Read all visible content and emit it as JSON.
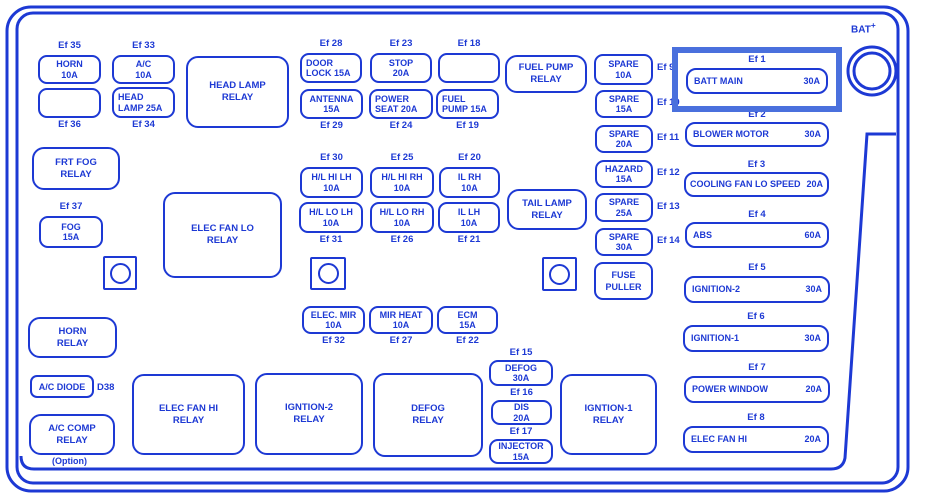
{
  "colors": {
    "line": "#1d39d4",
    "highlight": "#4a70dd",
    "background": "#ffffff"
  },
  "battery": {
    "label": "BAT",
    "sup": "+"
  },
  "misc": {
    "diode_code": "D38",
    "option_note": "(Option)"
  },
  "fuses": [
    {
      "ef": "Ef 35",
      "line1": "HORN",
      "line2": "10A"
    },
    {
      "ef": "Ef 33",
      "line1": "A/C",
      "line2": "10A"
    },
    {
      "ef": "Ef 36",
      "line1": "",
      "line2": ""
    },
    {
      "ef": "Ef 34",
      "line1": "HEAD",
      "line2": "LAMP 25A"
    },
    {
      "ef": "Ef 37",
      "line1": "FOG",
      "line2": "15A"
    },
    {
      "ef": "Ef 28",
      "line1": "DOOR",
      "line2": "LOCK 15A"
    },
    {
      "ef": "Ef 23",
      "line1": "STOP",
      "line2": "20A"
    },
    {
      "ef": "Ef 18",
      "line1": "",
      "line2": ""
    },
    {
      "ef": "Ef 29",
      "line1": "ANTENNA",
      "line2": "15A"
    },
    {
      "ef": "Ef 24",
      "line1": "POWER",
      "line2": "SEAT 20A"
    },
    {
      "ef": "Ef 19",
      "line1": "FUEL",
      "line2": "PUMP 15A"
    },
    {
      "ef": "Ef 30",
      "line1": "H/L HI LH",
      "line2": "10A"
    },
    {
      "ef": "Ef 25",
      "line1": "H/L HI RH",
      "line2": "10A"
    },
    {
      "ef": "Ef 20",
      "line1": "IL RH",
      "line2": "10A"
    },
    {
      "ef": "Ef 31",
      "line1": "H/L LO LH",
      "line2": "10A"
    },
    {
      "ef": "Ef 26",
      "line1": "H/L LO RH",
      "line2": "10A"
    },
    {
      "ef": "Ef 21",
      "line1": "IL LH",
      "line2": "10A"
    },
    {
      "ef": "Ef 32",
      "line1": "ELEC. MIR",
      "line2": "10A"
    },
    {
      "ef": "Ef 27",
      "line1": "MIR HEAT",
      "line2": "10A"
    },
    {
      "ef": "Ef 22",
      "line1": "ECM",
      "line2": "15A"
    },
    {
      "ef": "Ef 9",
      "line1": "SPARE",
      "line2": "10A"
    },
    {
      "ef": "Ef 10",
      "line1": "SPARE",
      "line2": "15A"
    },
    {
      "ef": "Ef 11",
      "line1": "SPARE",
      "line2": "20A"
    },
    {
      "ef": "Ef 12",
      "line1": "HAZARD",
      "line2": "15A"
    },
    {
      "ef": "Ef 13",
      "line1": "SPARE",
      "line2": "25A"
    },
    {
      "ef": "Ef 14",
      "line1": "SPARE",
      "line2": "30A"
    },
    {
      "ef": "Ef 15",
      "line1": "DEFOG",
      "line2": "30A"
    },
    {
      "ef": "Ef 16",
      "line1": "DIS",
      "line2": "20A"
    },
    {
      "ef": "Ef 17",
      "line1": "INJECTOR",
      "line2": "15A"
    },
    {
      "ef": "Ef 1",
      "line1": "BATT MAIN",
      "line2": "30A"
    },
    {
      "ef": "Ef 2",
      "line1": "BLOWER MOTOR",
      "line2": "30A"
    },
    {
      "ef": "Ef 3",
      "line1": "COOLING FAN LO SPEED",
      "line2": "20A"
    },
    {
      "ef": "Ef 4",
      "line1": "ABS",
      "line2": "60A"
    },
    {
      "ef": "Ef 5",
      "line1": "IGNITION-2",
      "line2": "30A"
    },
    {
      "ef": "Ef 6",
      "line1": "IGNITION-1",
      "line2": "30A"
    },
    {
      "ef": "Ef 7",
      "line1": "POWER WINDOW",
      "line2": "20A"
    },
    {
      "ef": "Ef 8",
      "line1": "ELEC FAN HI",
      "line2": "20A"
    }
  ],
  "relays": [
    {
      "name": "HEAD LAMP RELAY"
    },
    {
      "name": "FRT FOG RELAY"
    },
    {
      "name": "ELEC FAN LO RELAY"
    },
    {
      "name": "FUEL PUMP RELAY"
    },
    {
      "name": "TAIL LAMP RELAY"
    },
    {
      "name": "FUSE PULLER"
    },
    {
      "name": "HORN RELAY"
    },
    {
      "name": "A/C DIODE"
    },
    {
      "name": "A/C COMP RELAY"
    },
    {
      "name": "ELEC FAN HI RELAY"
    },
    {
      "name": "IGNTION-2 RELAY"
    },
    {
      "name": "DEFOG RELAY"
    },
    {
      "name": "IGNTION-1 RELAY"
    }
  ]
}
